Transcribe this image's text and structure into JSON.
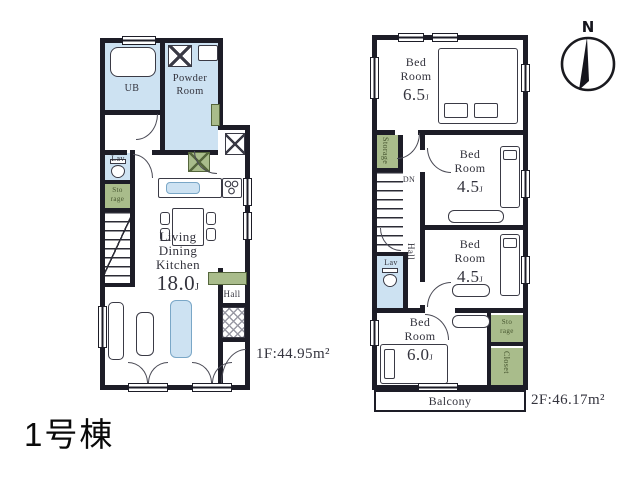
{
  "caption": "1号棟",
  "compass": {
    "north_label": "N"
  },
  "colors": {
    "wall": "#1d1d27",
    "water_blue": "#cde2f2",
    "storage_green": "#a9bc8b",
    "text": "#33333d"
  },
  "floor1": {
    "area_label": "1F:44.95m²",
    "ub_label": "UB",
    "powder_room_line1": "Powder",
    "powder_room_line2": "Room",
    "lav_label": "Lav",
    "storage_line1": "Sto",
    "storage_line2": "rage",
    "ldk_line1": "Living",
    "ldk_line2": "Dining",
    "ldk_line3": "Kitchen",
    "ldk_size": "18.0",
    "ldk_size_unit": "J",
    "hall_label": "Hall"
  },
  "floor2": {
    "area_label": "2F:46.17m²",
    "bedroom_top": {
      "line1": "Bed",
      "line2": "Room",
      "size": "6.5",
      "unit": "J"
    },
    "bedroom_mid1": {
      "line1": "Bed",
      "line2": "Room",
      "size": "4.5",
      "unit": "J"
    },
    "bedroom_mid2": {
      "line1": "Bed",
      "line2": "Room",
      "size": "4.5",
      "unit": "J"
    },
    "bedroom_bottom": {
      "line1": "Bed",
      "line2": "Room",
      "size": "6.0",
      "unit": "J"
    },
    "storage_left_label": "Storage",
    "storage_right_line1": "Sto",
    "storage_right_line2": "rage",
    "closet_label": "Closet",
    "hall_label": "Hall",
    "dn_label": "DN",
    "lav_label": "Lav",
    "balcony_label": "Balcony"
  }
}
